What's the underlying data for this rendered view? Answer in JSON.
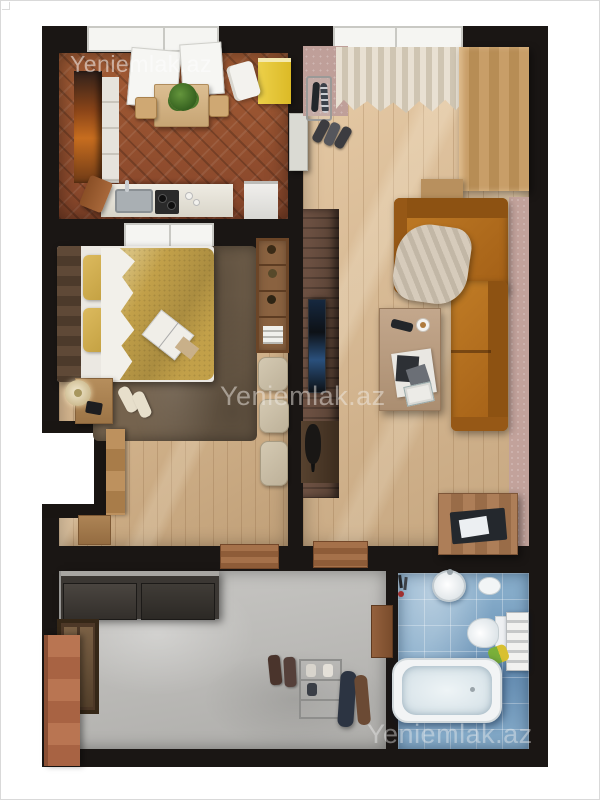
{
  "image": {
    "kind": "3d-rendered-floor-plan",
    "subject": "one-bedroom apartment top-down render",
    "background": "#ffffff"
  },
  "watermarks": [
    {
      "text": "Yeniemlak.az",
      "location": "kitchen-top-left"
    },
    {
      "text": "Yeniemlak.az",
      "location": "center-over-bedroom"
    },
    {
      "text": "Yeniemlak.az",
      "location": "bathroom-bottom-right"
    }
  ],
  "palette": {
    "walls": "#1a1614",
    "kitchen_floor": "#96512f",
    "living_floor": "#dcb98e",
    "bedroom_floor": "#d6b286",
    "hall_floor": "#bcbbb8",
    "bath_floor": "#85abc9",
    "sofa": "#b2701f",
    "duvet_gold": "#c2a049",
    "accent_yellow_cabinet": "#e6c836",
    "rug_brown": "#75634e",
    "pink_wall": "#c2a29b",
    "terracotta_door": "#b5714f"
  },
  "rooms": [
    {
      "name": "kitchen",
      "furniture": [
        "cabinet-column",
        "tall-cabinet",
        "counter-with-sink",
        "hob",
        "cutting-board",
        "appliance",
        "dining-table",
        "plant",
        "stools",
        "yellow-cabinet",
        "towel",
        "window-open-sashes"
      ]
    },
    {
      "name": "living-room",
      "furniture": [
        "curtained-window",
        "umbrella-stand",
        "entry-shoes",
        "tall-wood-cabinet",
        "corner-sofa",
        "blanket",
        "coffee-table",
        "remote",
        "cup",
        "magazines",
        "tv-feature-wall",
        "tv",
        "speaker",
        "storage-chest",
        "laptop"
      ]
    },
    {
      "name": "bedroom",
      "furniture": [
        "double-bed",
        "gold-duvet",
        "pillows",
        "shag-rug",
        "nightstand",
        "lamp",
        "phone",
        "slippers",
        "open-magazine",
        "bookshelf",
        "poufs",
        "wardrobe",
        "dresser",
        "window"
      ]
    },
    {
      "name": "hallway",
      "furniture": [
        "sliding-wardrobe",
        "mirror-panel",
        "entrance-door",
        "shoes",
        "shoe-rack",
        "hanging-coats",
        "thresholds"
      ]
    },
    {
      "name": "bathroom",
      "furniture": [
        "sink",
        "bidet",
        "toilet",
        "towel-shelf",
        "bathtub",
        "toiletries",
        "door"
      ]
    }
  ]
}
